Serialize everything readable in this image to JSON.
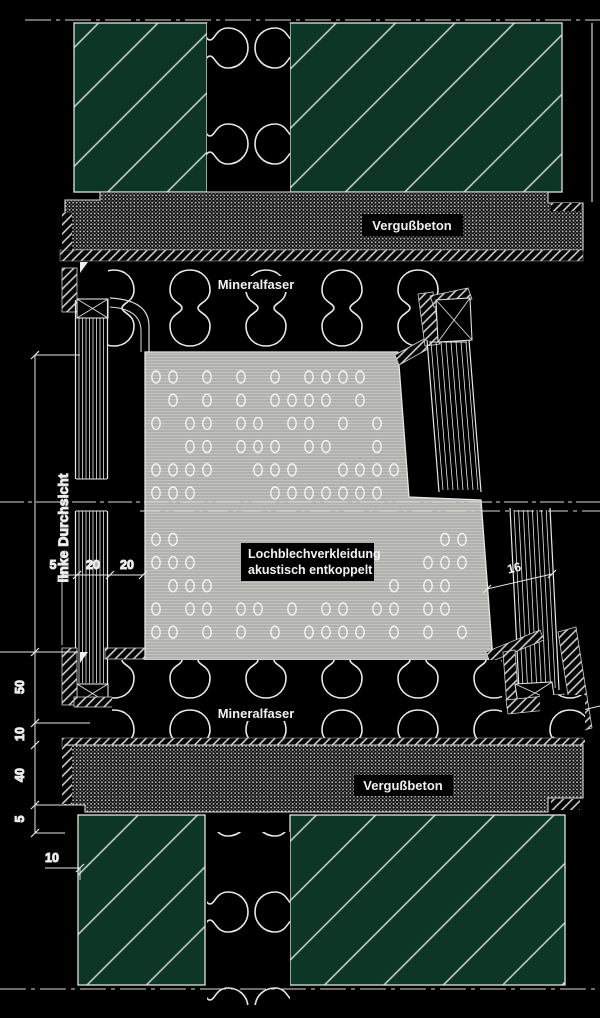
{
  "drawing": {
    "labels": {
      "vergussbeton_top": "Vergußbeton",
      "vergussbeton_bottom": "Vergußbeton",
      "mineralfaser_top": "Mineralfaser",
      "mineralfaser_bottom": "Mineralfaser",
      "lochblech_line1": "Lochblechverkleidung",
      "lochblech_line2": "akustisch entkoppelt",
      "linke_durchsicht": "linke Durchsicht"
    },
    "dimensions": {
      "glass_left": [
        "5",
        "20",
        "20"
      ],
      "left_chain": [
        "50",
        "10",
        "40",
        "5"
      ],
      "bottom_left": "10",
      "glass_right": "16"
    },
    "colors": {
      "background": "#000000",
      "concrete_green": "#0d3627",
      "hatch_line": "#ccd6cc",
      "panel_gray": "#b3b3b0",
      "line_white": "#e8e8e8",
      "label_text": "#f2f2f2"
    }
  }
}
